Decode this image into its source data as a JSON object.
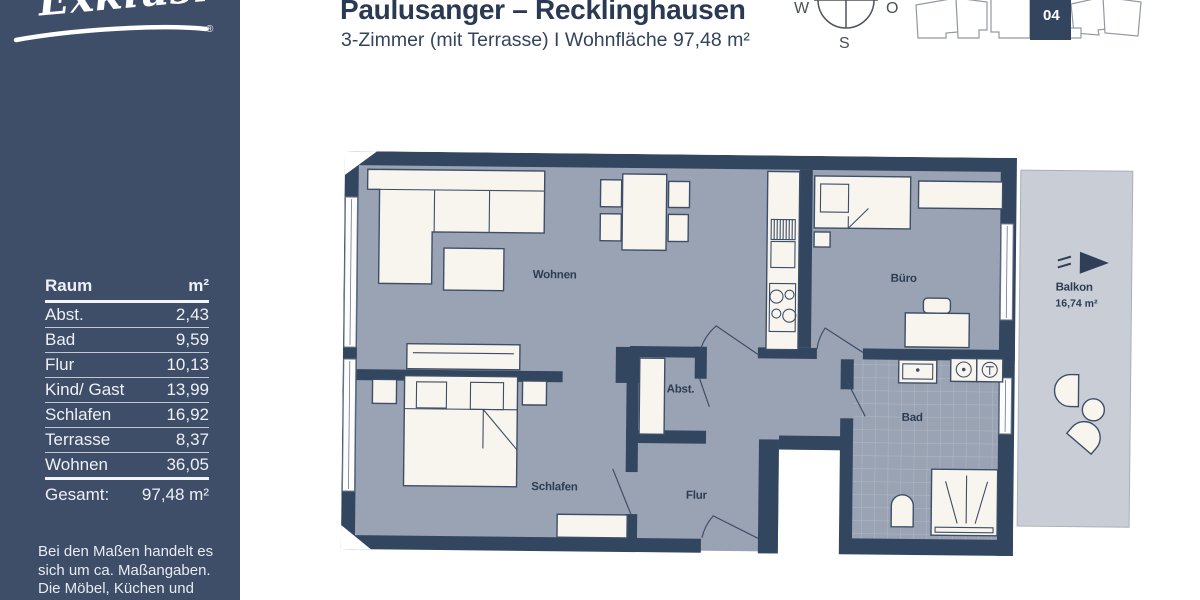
{
  "sidebar": {
    "logo_text": "Exklusiv",
    "logo_reg": "®",
    "table": {
      "headers": {
        "room": "Raum",
        "area": "m²"
      },
      "rows": [
        {
          "room": "Abst.",
          "area": "2,43"
        },
        {
          "room": "Bad",
          "area": "9,59"
        },
        {
          "room": "Flur",
          "area": "10,13"
        },
        {
          "room": "Kind/ Gast",
          "area": "13,99"
        },
        {
          "room": "Schlafen",
          "area": "16,92"
        },
        {
          "room": "Terrasse",
          "area": "8,37"
        },
        {
          "room": "Wohnen",
          "area": "36,05"
        }
      ],
      "total": {
        "room": "Gesamt:",
        "area": "97,48 m²"
      }
    },
    "disclaimer_lines": [
      "Bei den Maßen handelt es",
      "sich um ca. Maßangaben.",
      "Die Möbel, Küchen und",
      "Sanitärobjekte sind"
    ]
  },
  "header": {
    "title": "Paulusanger – Recklinghausen",
    "subtitle": "3-Zimmer (mit Terrasse) I Wohnfläche 97,48 m²"
  },
  "compass": {
    "west": "W",
    "east": "O",
    "south": "S"
  },
  "site_plan": {
    "unit_number": "04"
  },
  "floor_plan": {
    "rooms": {
      "wohnen": "Wohnen",
      "buero": "Büro",
      "schlafen": "Schlafen",
      "flur": "Flur",
      "bad": "Bad",
      "abst": "Abst.",
      "balkon": "Balkon",
      "balkon_area": "16,74 m²"
    }
  },
  "colors": {
    "sidebar_navy": "#3E4D68",
    "wall_navy": "#334660",
    "floor_gray": "#9AA3B3",
    "balcony_gray": "#C9CDD6",
    "furniture_cream": "#F8F5EF",
    "title_navy": "#2A3A52",
    "unit_highlight": "#33455E"
  }
}
